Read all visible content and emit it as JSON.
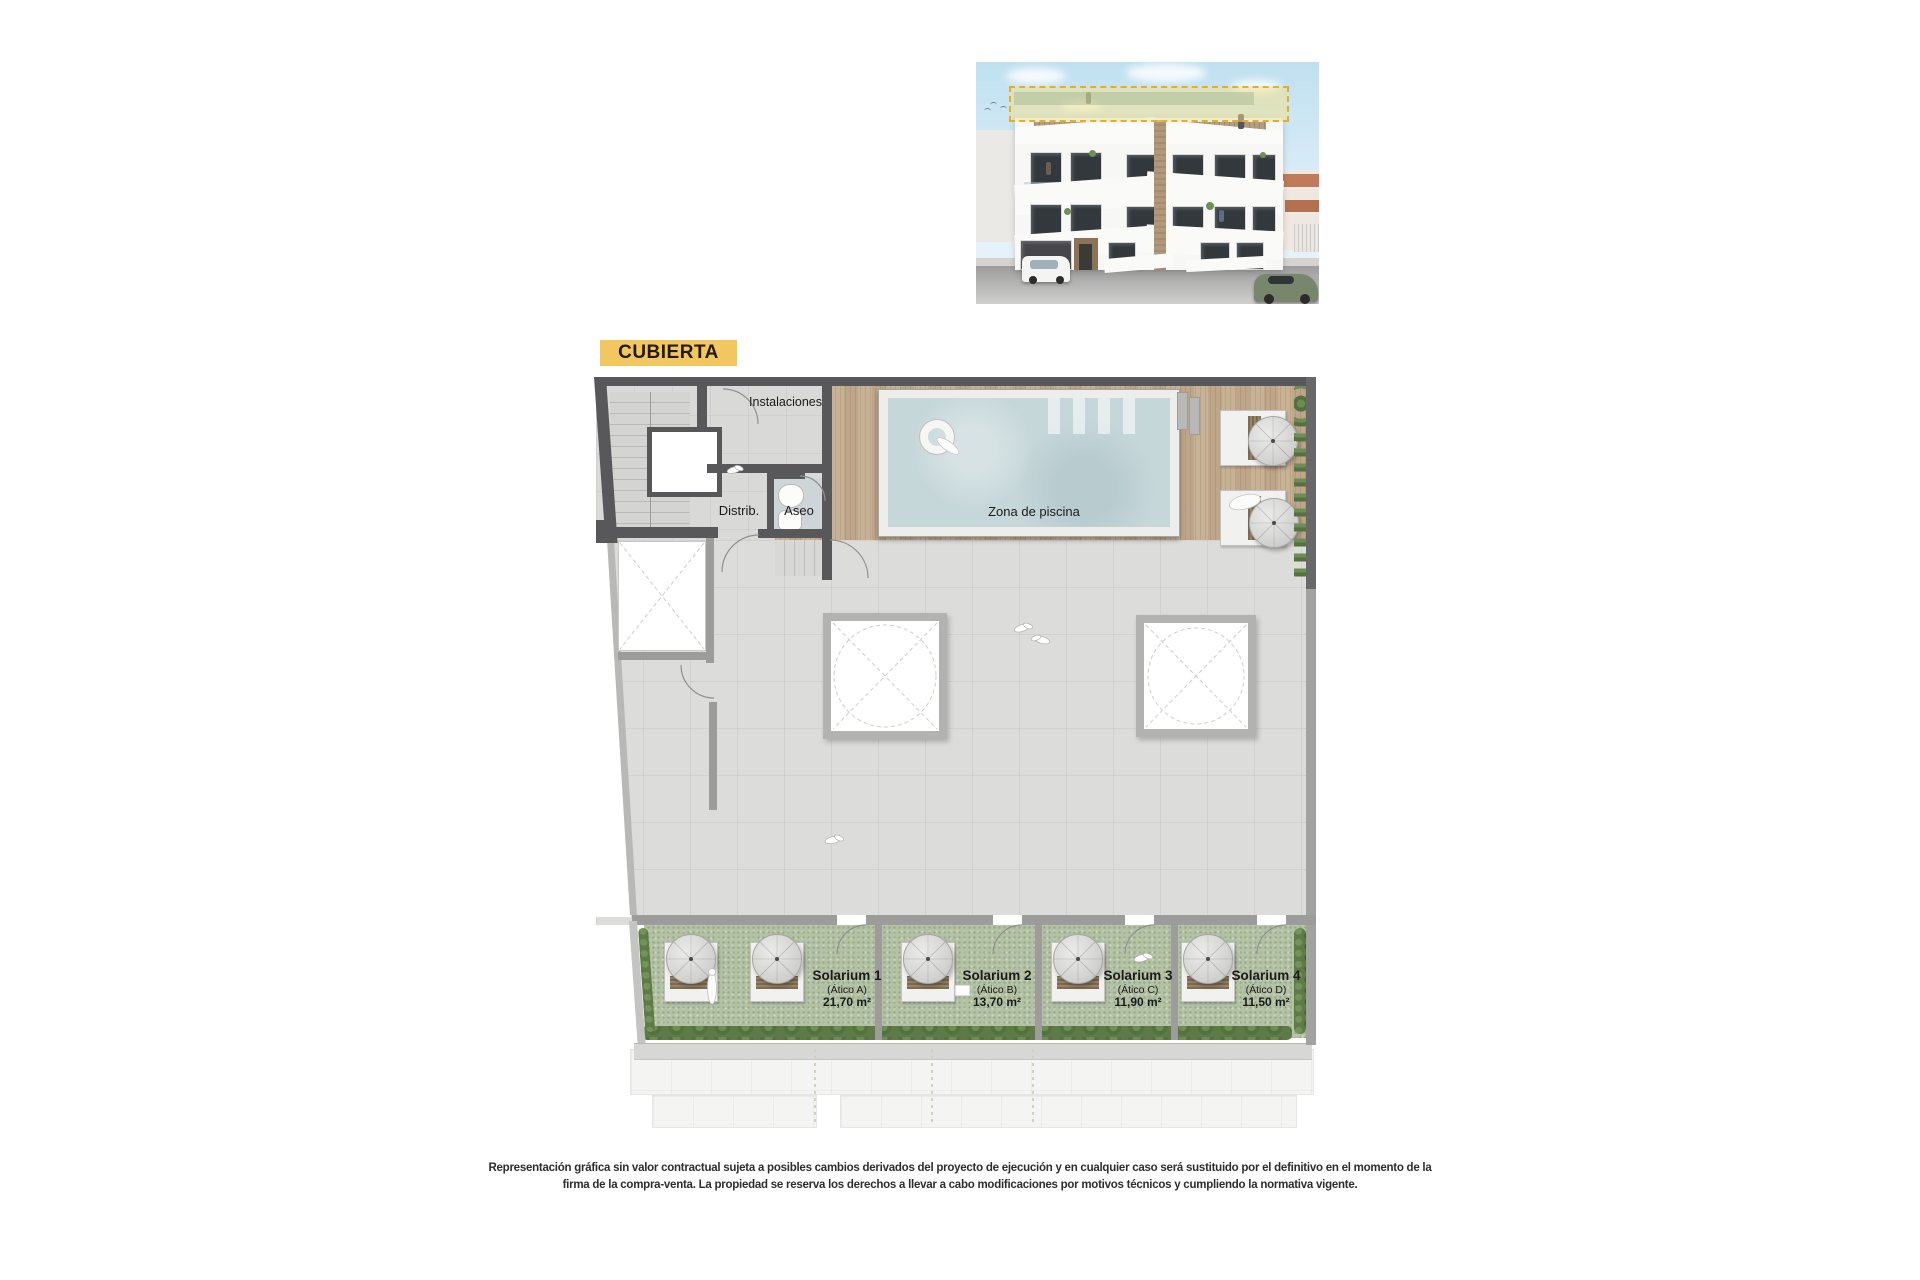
{
  "document": {
    "type": "roof-floor-plan-marketing-page",
    "background": "#ffffff"
  },
  "building_render": {
    "description": "Front elevation render of a white three-storey apartment building; rooftop level highlighted with yellow dashed outline",
    "highlight_border_color": "#e0ae34",
    "highlight_fill_color": "rgba(244,226,138,0.5)"
  },
  "plan": {
    "title": "CUBIERTA",
    "title_colors": {
      "background": "#f3c75f",
      "text": "#221a10"
    },
    "rooms": {
      "instalaciones": "Instalaciones",
      "distribuidor": "Distrib.",
      "aseo": "Aseo",
      "pool_area": "Zona de piscina"
    },
    "solariums": [
      {
        "name": "Solarium 1",
        "unit": "(Ático A)",
        "area": "21,70 m²"
      },
      {
        "name": "Solarium 2",
        "unit": "(Ático B)",
        "area": "13,70 m²"
      },
      {
        "name": "Solarium 3",
        "unit": "(Ático C)",
        "area": "11,90 m²"
      },
      {
        "name": "Solarium 4",
        "unit": "(Ático D)",
        "area": "11,50 m²"
      }
    ],
    "materials": {
      "deck_wood": "#c4ad90",
      "pool_water": "#c6d7da",
      "terrace_tile": "#dcdcda",
      "solarium_turf": "#b3c1a4",
      "wall_dark": "#58585a",
      "wall_mid": "#9c9c9a",
      "planter_green": "#5e7b47"
    }
  },
  "disclaimer": {
    "line1": "Representación gráfica sin valor contractual sujeta a posibles cambios derivados del proyecto de ejecución y en cualquier caso será sustituido por el definitivo en el momento de la",
    "line2": "firma de la compra-venta. La propiedad se reserva los derechos a llevar a cabo modificaciones por motivos técnicos y cumpliendo la normativa vigente."
  }
}
